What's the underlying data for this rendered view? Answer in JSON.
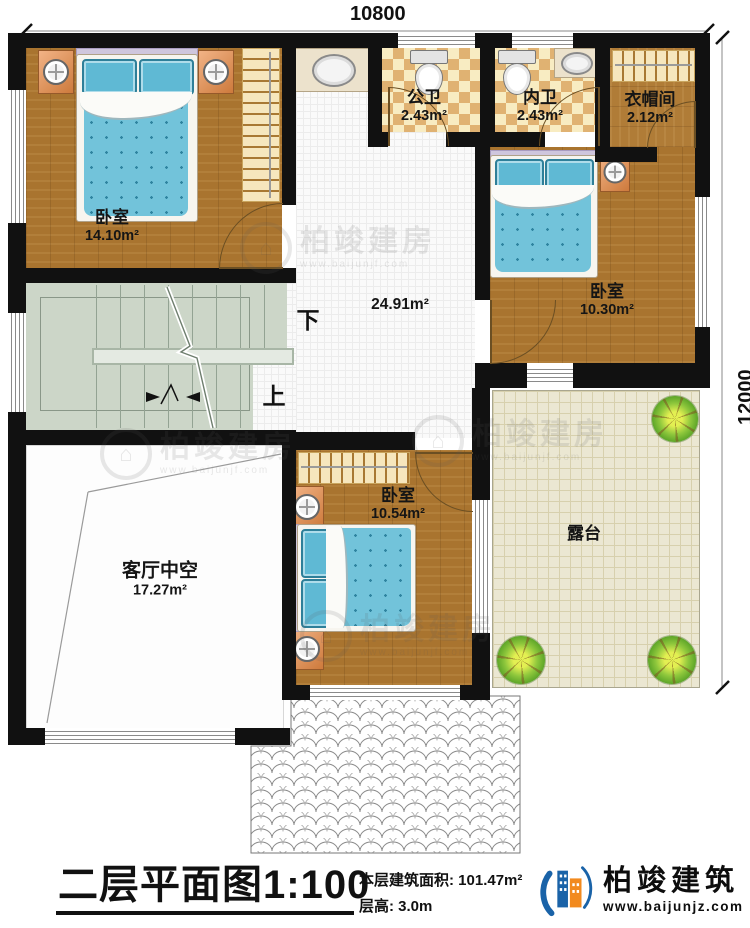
{
  "plan": {
    "dimensions": {
      "top": "10800",
      "right": "12000"
    },
    "rooms": {
      "bedroom1": {
        "label": "卧室",
        "area": "14.10m²"
      },
      "public_bath": {
        "label": "公卫",
        "area": "2.43m²"
      },
      "inner_bath": {
        "label": "内卫",
        "area": "2.43m²"
      },
      "cloakroom": {
        "label": "衣帽间",
        "area": "2.12m²"
      },
      "bedroom2": {
        "label": "卧室",
        "area": "10.30m²"
      },
      "hall": {
        "area": "24.91m²"
      },
      "bedroom3": {
        "label": "卧室",
        "area": "10.54m²"
      },
      "living_void": {
        "label": "客厅中空",
        "area": "17.27m²"
      },
      "terrace": {
        "label": "露台"
      }
    },
    "stairs": {
      "down": "下",
      "up": "上"
    }
  },
  "titleblock": {
    "title": "二层平面图",
    "scale": "1:100",
    "floor_area_label": "本层建筑面积:",
    "floor_area_value": "101.47m²",
    "floor_height_label": "层高:",
    "floor_height_value": "3.0m"
  },
  "brand": {
    "name": "柏竣建筑",
    "website": "www.baijunjz.com"
  },
  "watermark": {
    "name": "柏竣建房",
    "website": "www.baijunjf.com",
    "glyph": "⌂"
  },
  "colors": {
    "wall": "#111111",
    "wood": "#a9742f",
    "bed": "#72c3da",
    "stairs": "#ccd6c8",
    "terrace": "#ebe7d2"
  }
}
